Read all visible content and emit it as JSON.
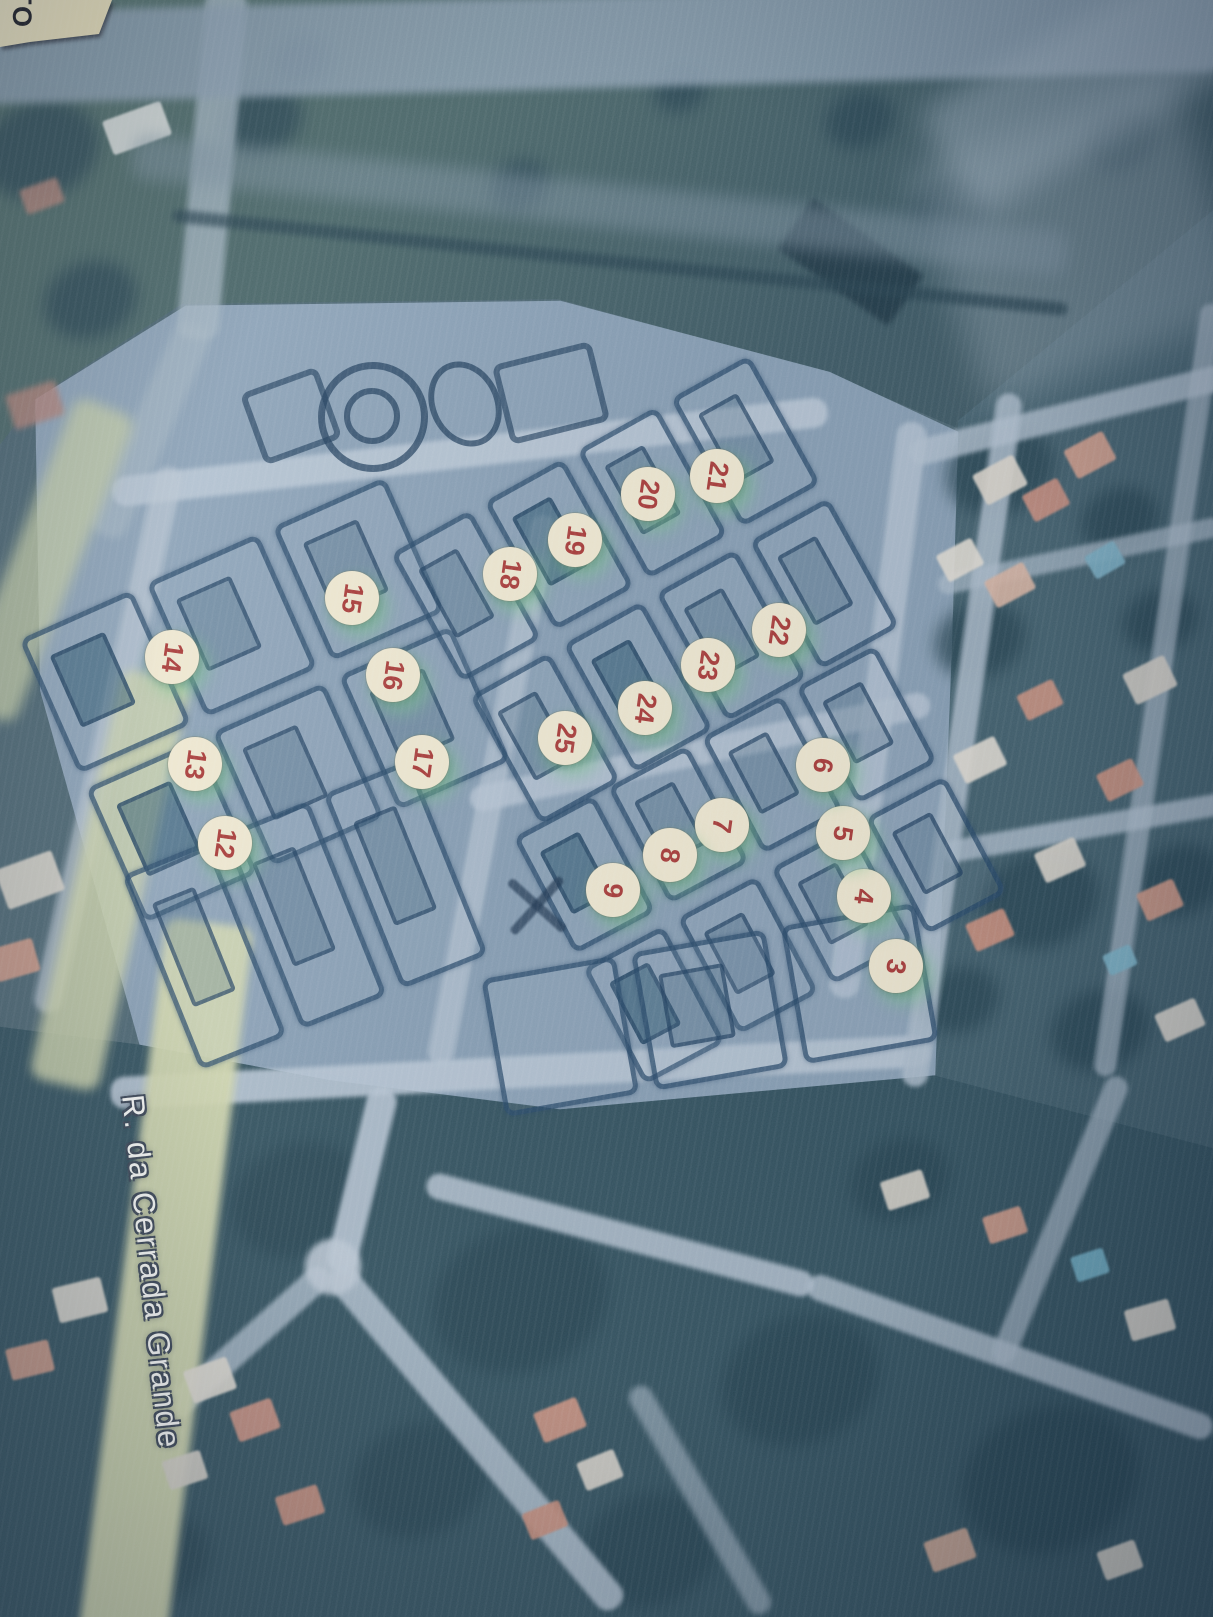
{
  "photo": {
    "description": "Printed aerial photograph with numbered lot-plan overlay",
    "street": {
      "label": "R. da Cerrada Grande"
    },
    "paper_corner": {
      "text": "TO"
    },
    "markers": {
      "shape": "circle-sticker",
      "fill": "#f1ead1",
      "number_color": "#a83834",
      "glow_color": "#74c488",
      "items": [
        {
          "number": "3",
          "x": 896,
          "y": 966
        },
        {
          "number": "4",
          "x": 864,
          "y": 896
        },
        {
          "number": "5",
          "x": 843,
          "y": 833
        },
        {
          "number": "6",
          "x": 823,
          "y": 765
        },
        {
          "number": "7",
          "x": 722,
          "y": 825
        },
        {
          "number": "8",
          "x": 670,
          "y": 855
        },
        {
          "number": "9",
          "x": 613,
          "y": 890
        },
        {
          "number": "12",
          "x": 225,
          "y": 843
        },
        {
          "number": "13",
          "x": 195,
          "y": 764
        },
        {
          "number": "14",
          "x": 172,
          "y": 657
        },
        {
          "number": "15",
          "x": 352,
          "y": 598
        },
        {
          "number": "16",
          "x": 393,
          "y": 675
        },
        {
          "number": "17",
          "x": 422,
          "y": 762
        },
        {
          "number": "18",
          "x": 510,
          "y": 574
        },
        {
          "number": "19",
          "x": 575,
          "y": 540
        },
        {
          "number": "20",
          "x": 648,
          "y": 494
        },
        {
          "number": "21",
          "x": 717,
          "y": 476
        },
        {
          "number": "22",
          "x": 779,
          "y": 630
        },
        {
          "number": "23",
          "x": 708,
          "y": 665
        },
        {
          "number": "24",
          "x": 645,
          "y": 708
        },
        {
          "number": "25",
          "x": 565,
          "y": 738
        }
      ]
    },
    "colors": {
      "plan_fill": "#8aa2b8",
      "lot_line": "#2b4b6e",
      "field_green": "#3a5761",
      "road_light": "#b5c5d3",
      "road_yellow": "#d2d8ae",
      "roof_salmon": "#c98f7e",
      "pool_blue": "#6fafc4",
      "house_white": "#ddd9cf"
    }
  }
}
